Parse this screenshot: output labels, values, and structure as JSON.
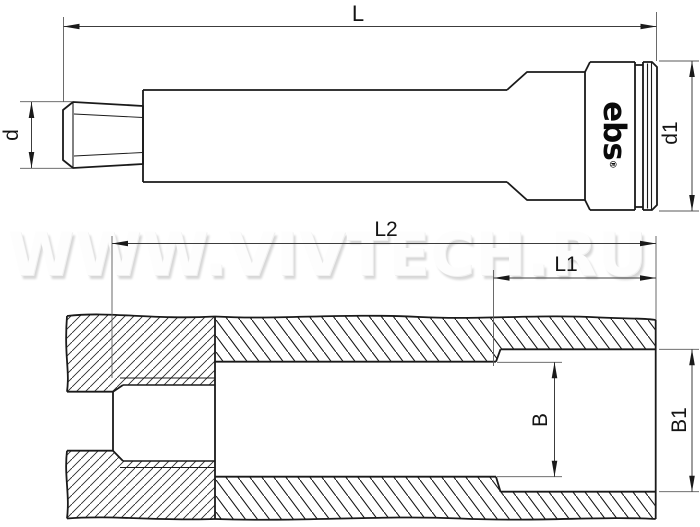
{
  "watermark": {
    "text": "WWW.VIVTECH.RU"
  },
  "logo": {
    "text": "ebs",
    "registered_mark": "®"
  },
  "top_view": {
    "labels": {
      "overall_length": "L",
      "thread_diameter": "d",
      "body_diameter": "d1"
    }
  },
  "section_view": {
    "labels": {
      "thread_to_end_length": "L2",
      "counterbore_depth": "L1",
      "bore_diameter": "B",
      "counterbore_diameter": "B1"
    }
  },
  "colors": {
    "outline": "#1a1a1a",
    "dimension_line": "#3c3c3c",
    "extension_line": "#5a5a5a",
    "watermark_fill": "#fdfdfd",
    "watermark_shadow": "#d7d7d7"
  }
}
